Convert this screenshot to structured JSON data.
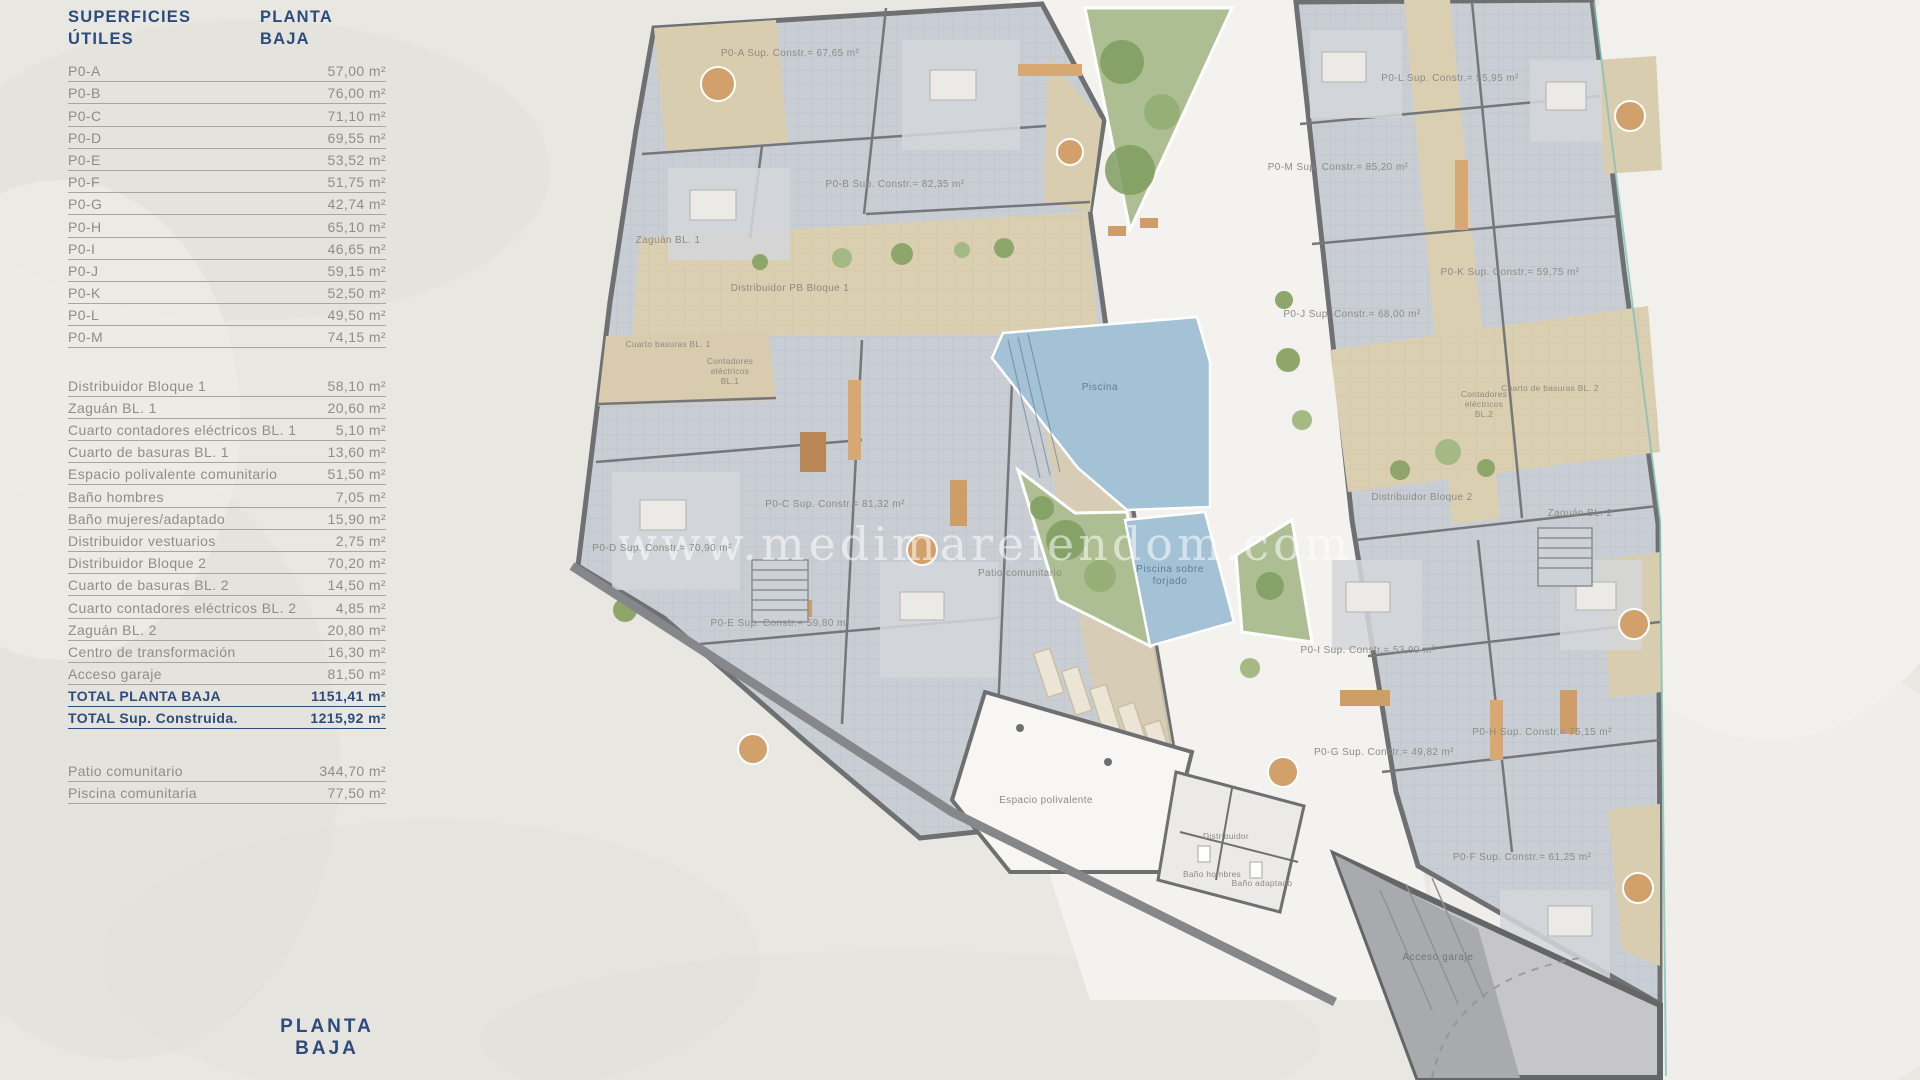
{
  "page": {
    "footer_title": "PLANTA BAJA"
  },
  "colors": {
    "accent_blue": "#2d4c7b",
    "text_gray": "#8f8d86",
    "background": "#e9e7e2",
    "room_gray": "#c9ced5",
    "wall_gray": "#6e7072",
    "corridor_tan": "#dbcfb2",
    "pool_blue": "#a3c2d5",
    "green": "#a9bd8c",
    "garage_gray": "#b3b4b6"
  },
  "table": {
    "title": "SUPERFICIES ÚTILES",
    "title_right": "PLANTA BAJA",
    "apartments": [
      {
        "label": "P0-A",
        "value": "57,00 m²"
      },
      {
        "label": "P0-B",
        "value": "76,00 m²"
      },
      {
        "label": "P0-C",
        "value": "71,10 m²"
      },
      {
        "label": "P0-D",
        "value": "69,55 m²"
      },
      {
        "label": "P0-E",
        "value": "53,52 m²"
      },
      {
        "label": "P0-F",
        "value": "51,75 m²"
      },
      {
        "label": "P0-G",
        "value": "42,74 m²"
      },
      {
        "label": "P0-H",
        "value": "65,10 m²"
      },
      {
        "label": "P0-I",
        "value": "46,65 m²"
      },
      {
        "label": "P0-J",
        "value": "59,15 m²"
      },
      {
        "label": "P0-K",
        "value": "52,50 m²"
      },
      {
        "label": "P0-L",
        "value": "49,50 m²"
      },
      {
        "label": "P0-M",
        "value": "74,15 m²"
      }
    ],
    "common": [
      {
        "label": "Distribuidor Bloque 1",
        "value": "58,10 m²"
      },
      {
        "label": "Zaguán BL. 1",
        "value": "20,60 m²"
      },
      {
        "label": "Cuarto contadores eléctricos BL. 1",
        "value": "5,10 m²"
      },
      {
        "label": "Cuarto de basuras BL. 1",
        "value": "13,60 m²"
      },
      {
        "label": "Espacio polivalente comunitario",
        "value": "51,50 m²"
      },
      {
        "label": "Baño hombres",
        "value": "7,05 m²"
      },
      {
        "label": "Baño mujeres/adaptado",
        "value": "15,90 m²"
      },
      {
        "label": "Distribuidor vestuarios",
        "value": "2,75 m²"
      },
      {
        "label": "Distribuidor Bloque 2",
        "value": "70,20 m²"
      },
      {
        "label": "Cuarto de basuras BL. 2",
        "value": "14,50 m²"
      },
      {
        "label": "Cuarto contadores eléctricos BL. 2",
        "value": "4,85 m²"
      },
      {
        "label": "Zaguán BL. 2",
        "value": "20,80 m²"
      },
      {
        "label": "Centro de transformación",
        "value": "16,30 m²"
      },
      {
        "label": "Acceso garaje",
        "value": "81,50 m²"
      }
    ],
    "totals": [
      {
        "label": "TOTAL PLANTA BAJA",
        "value": "1151,41 m²"
      },
      {
        "label": "TOTAL Sup. Construida.",
        "value": "1215,92 m²"
      }
    ],
    "outdoor": [
      {
        "label": "Patio comunitario",
        "value": "344,70 m²"
      },
      {
        "label": "Piscina comunitaria",
        "value": "77,50 m²"
      }
    ]
  },
  "plan": {
    "watermark": "www.medimareiendom.com",
    "labels": {
      "p0a": "P0-A Sup. Constr.= 67,65 m²",
      "p0b": "P0-B Sup. Constr.= 82,35 m²",
      "p0c": "P0-C Sup. Constr.= 81,32 m²",
      "p0d": "P0-D Sup. Constr.= 70,90 m²",
      "p0e": "P0-E Sup. Constr.= 59,80 m²",
      "p0f": "P0-F Sup. Constr.= 61,25 m²",
      "p0g": "P0-G Sup. Constr.= 49,82 m²",
      "p0h": "P0-H Sup. Constr.= 75,15 m²",
      "p0i": "P0-I Sup. Constr.= 53,90 m²",
      "p0j": "P0-J Sup. Constr.= 68,00 m²",
      "p0k": "P0-K Sup. Constr.= 59,75 m²",
      "p0l": "P0-L Sup. Constr.= 55,95 m²",
      "p0m": "P0-M Sup. Constr.= 85,20 m²",
      "zaguan1": "Zaguán BL. 1",
      "distribuidor1": "Distribuidor PB Bloque 1",
      "basuras1": "Cuarto basuras BL. 1",
      "cont1_l1": "Contadores",
      "cont1_l2": "eléctricos",
      "cont1_l3": "BL.1",
      "basuras2": "Cuarto de basuras BL. 2",
      "cont2_l1": "Contadores",
      "cont2_l2": "eléctricos",
      "cont2_l3": "BL.2",
      "distribuidor2": "Distribuidor Bloque 2",
      "zaguan2": "Zaguán BL. 2",
      "piscina": "Piscina",
      "forjado_l1": "Piscina sobre",
      "forjado_l2": "forjado",
      "patio": "Patio comunitario",
      "espacio": "Espacio polivalente",
      "distribuidor": "Distribuidor",
      "bano_hombres": "Baño hombres",
      "bano_adaptado": "Baño adaptado",
      "acceso_garaje": "Acceso garaje"
    }
  }
}
